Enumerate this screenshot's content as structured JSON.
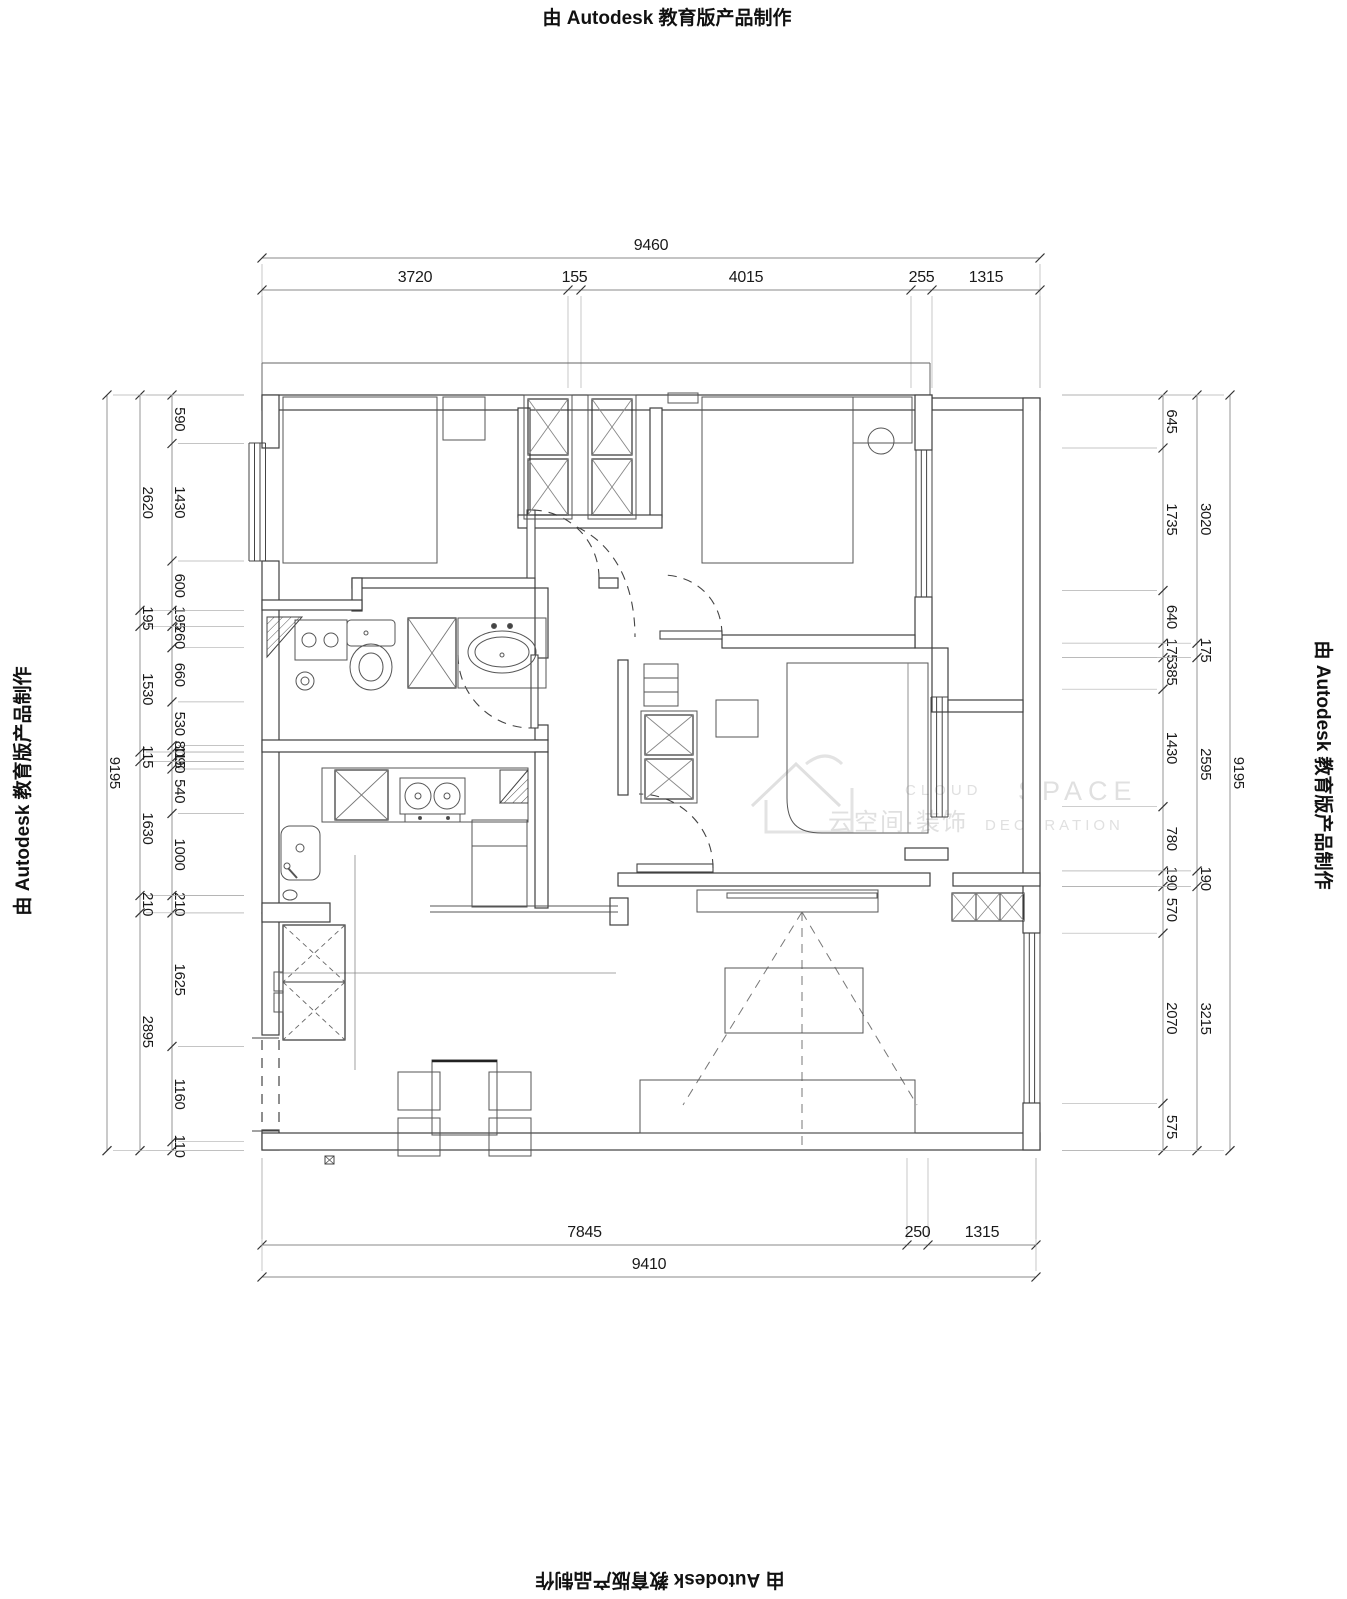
{
  "edge_stamps": {
    "top": "由 Autodesk 教育版产品制作",
    "bottom": "由 Autodesk 教育版产品制作",
    "left": "由 Autodesk 教育版产品制作",
    "right": "由 Autodesk 教育版产品制作"
  },
  "watermark": {
    "cloud": "CLOUD",
    "space": "SPACE",
    "cn": "云空间·装饰",
    "decoration": "DECORATION"
  },
  "dims": {
    "top": {
      "total": "9460",
      "segments": [
        "3720",
        "155",
        "4015",
        "255",
        "1315"
      ]
    },
    "bottom": {
      "total": "9410",
      "segments": [
        "7845",
        "250",
        "1315"
      ]
    },
    "left": {
      "total": "9195",
      "middle": [
        "2620",
        "195",
        "1530",
        "115",
        "1630",
        "210",
        "2895"
      ],
      "inner": [
        "590",
        "1430",
        "600",
        "195",
        "260",
        "660",
        "530",
        "80",
        "115",
        "90",
        "540",
        "1000",
        "210",
        "1625",
        "1160",
        "110"
      ]
    },
    "right": {
      "total": "9195",
      "middle": [
        "3020",
        "175",
        "2595",
        "190",
        "3215"
      ],
      "inner": [
        "645",
        "1735",
        "640",
        "175",
        "385",
        "1430",
        "780",
        "190",
        "570",
        "2070",
        "575"
      ]
    }
  }
}
